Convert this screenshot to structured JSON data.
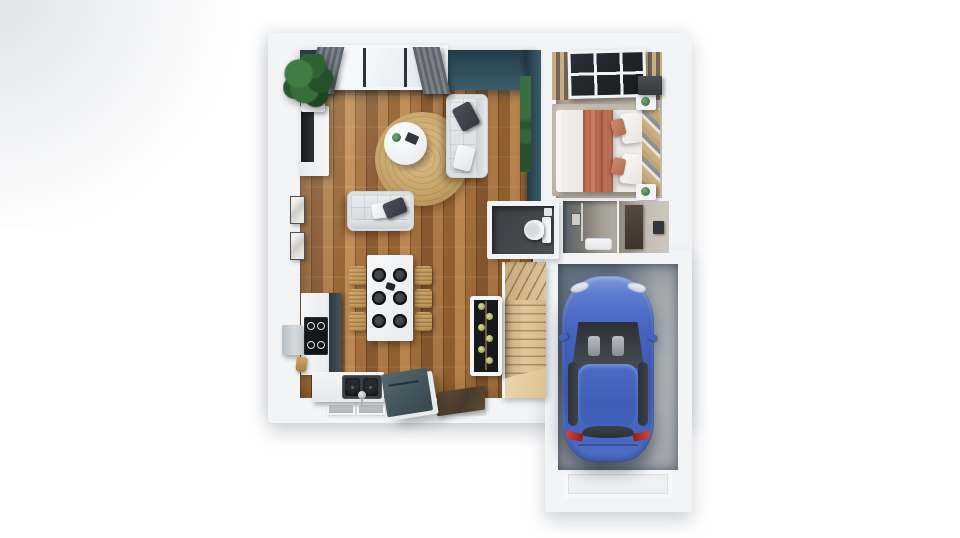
{
  "scene": {
    "type": "3d-floor-plan-render",
    "view": "top-down",
    "rooms": [
      {
        "id": "living-room",
        "floor": "oak-plank",
        "items": [
          "teal-accent-wall",
          "window-with-curtains",
          "corner-plant",
          "tv-sideboard",
          "round-jute-rug",
          "coffee-table",
          "sofa-large",
          "sofa-small",
          "wall-art"
        ]
      },
      {
        "id": "dining-area",
        "floor": "oak-plank",
        "items": [
          "dining-table",
          "rattan-chairs",
          "dark-plates",
          "centerpiece"
        ]
      },
      {
        "id": "kitchen",
        "floor": "oak-plank",
        "items": [
          "induction-cooktop",
          "range-hood",
          "double-sink",
          "slate-island",
          "wine-cooler",
          "slate-cabinet"
        ]
      },
      {
        "id": "bedroom",
        "floor": "taupe-carpet",
        "items": [
          "double-bed",
          "terracotta-throw",
          "white-pillows",
          "slat-headboard",
          "nightstands",
          "wardrobe",
          "skylight",
          "ceiling-beams",
          "area-rug"
        ]
      },
      {
        "id": "wc",
        "floor": "charcoal-tile",
        "items": [
          "toilet"
        ]
      },
      {
        "id": "bathroom",
        "floor": "stone-gray",
        "items": [
          "shower-tray",
          "wall-art",
          "glass-screen"
        ]
      },
      {
        "id": "hallway",
        "floor": "taupe",
        "items": [
          "interior-door",
          "wall-thermostat"
        ]
      },
      {
        "id": "staircase",
        "floor": "light-oak",
        "items": [
          "winder-steps",
          "landing"
        ]
      },
      {
        "id": "garage",
        "floor": "concrete",
        "items": [
          "blue-car",
          "garage-door"
        ]
      }
    ],
    "vehicle": {
      "kind": "car",
      "body_color_name": "blue",
      "location": "garage"
    },
    "counts": {
      "dining_plates": 6,
      "dining_chairs": 6,
      "wine_bottles": 6,
      "sofas": 2,
      "bed_pillows": 2,
      "nightstands": 2,
      "wall_art_frames": 2,
      "bottom_wall_windows": 2
    }
  },
  "colors": {
    "page-bg": "#ffffff",
    "wall": "#f3f4f6",
    "wood-a": "#a5713d",
    "wood-b": "#8a5a30",
    "wood-c": "#b07c48",
    "wood-d": "#96632f",
    "wood-e": "#c08a52",
    "teal-dark": "#243d48",
    "teal": "#2e4c59",
    "teal-light": "#3a5d6a",
    "curtain-a": "#5d646b",
    "curtain-b": "#7b828a",
    "rug-a": "#d4b47c",
    "rug-b": "#b6935a",
    "sofa": "#dcdfe2",
    "pillow-dark": "#33383f",
    "chair-rattan": "#b9904f",
    "plate": "#26292e",
    "slate-cabinet": "#46525a",
    "island-a": "#57696f",
    "island-b": "#39474f",
    "stair-a": "#cdb083",
    "stair-b": "#e0c79a",
    "mat": "#49382a",
    "wc-floor": "#4a4e55",
    "hall-a": "#8f887f",
    "hall-b": "#cdc6bc",
    "bedroom-a": "#9e948a",
    "bedroom-b": "#cac0b4",
    "bed-rug": "#c6beb0",
    "duvet": "#e9e6e1",
    "throw-a": "#cd7f63",
    "throw-b": "#ad5f47",
    "slat-a": "#cbb083",
    "slat-b": "#8d9296",
    "concrete-a": "#848b93",
    "concrete-b": "#99a0a6",
    "car-a": "#8099de",
    "car-b": "#3a57b0",
    "car-glass": "#2e333a",
    "taillight": "#d2453c",
    "plant": "#2e6134",
    "bottle": "#8f9642",
    "beam": "#c9ae84",
    "skylight": "#171a1f"
  }
}
